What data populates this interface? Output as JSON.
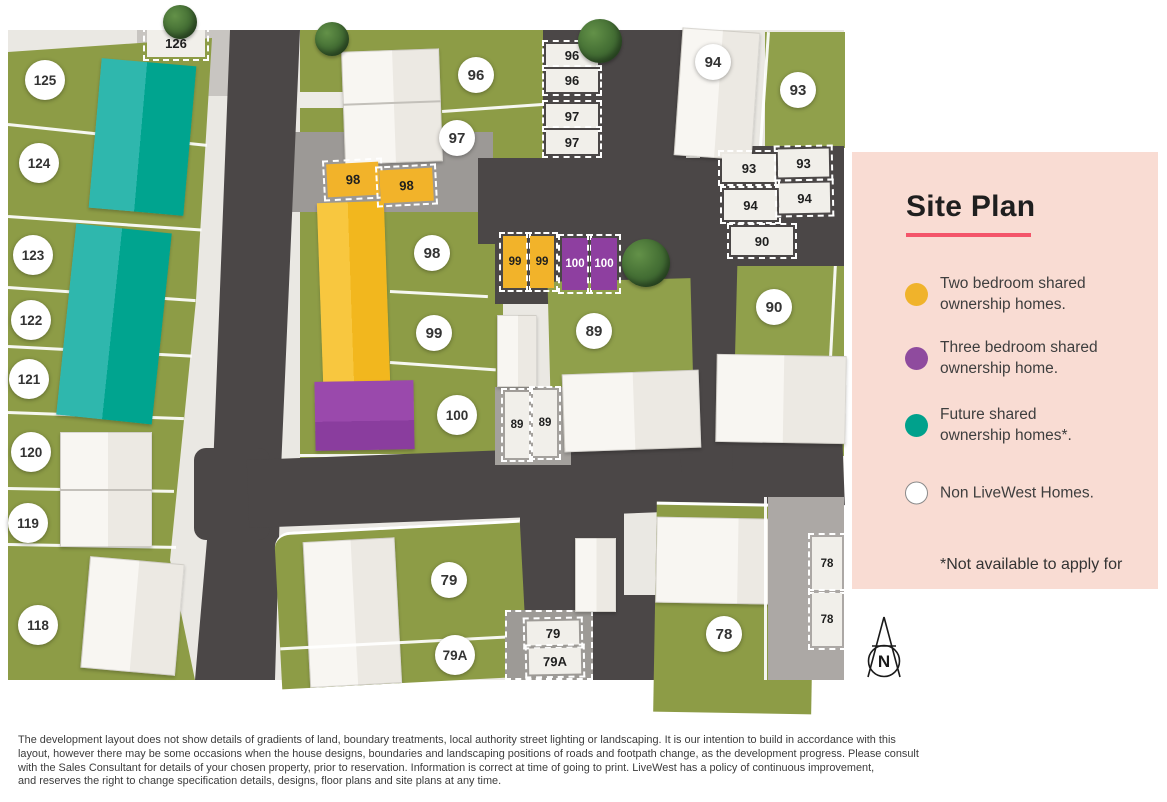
{
  "legend": {
    "title": "Site Plan",
    "items": [
      {
        "id": "two-bed-shared",
        "color": "#F0B32B",
        "line1": "Two bedroom shared",
        "line2": "ownership homes."
      },
      {
        "id": "three-bed-shared",
        "color": "#8F4B9E",
        "line1": "Three bedroom shared",
        "line2": "ownership home."
      },
      {
        "id": "future-shared",
        "color": "#00A18C",
        "line1": "Future shared",
        "line2": "ownership homes*."
      },
      {
        "id": "non-livewest",
        "color": "#FFFFFF",
        "line1": "Non LiveWest Homes.",
        "line2": ""
      }
    ],
    "footnote": "*Not available to apply for"
  },
  "compass": {
    "label": "N"
  },
  "map": {
    "plot_circles": [
      {
        "id": "125",
        "label": "125"
      },
      {
        "id": "124",
        "label": "124"
      },
      {
        "id": "123",
        "label": "123"
      },
      {
        "id": "122",
        "label": "122"
      },
      {
        "id": "121",
        "label": "121"
      },
      {
        "id": "120",
        "label": "120"
      },
      {
        "id": "119",
        "label": "119"
      },
      {
        "id": "118",
        "label": "118"
      },
      {
        "id": "96",
        "label": "96"
      },
      {
        "id": "97",
        "label": "97"
      },
      {
        "id": "98",
        "label": "98"
      },
      {
        "id": "99",
        "label": "99"
      },
      {
        "id": "100",
        "label": "100"
      },
      {
        "id": "89",
        "label": "89"
      },
      {
        "id": "90",
        "label": "90"
      },
      {
        "id": "94",
        "label": "94"
      },
      {
        "id": "93",
        "label": "93"
      },
      {
        "id": "79",
        "label": "79"
      },
      {
        "id": "79A",
        "label": "79A"
      },
      {
        "id": "78",
        "label": "78"
      }
    ],
    "parking_spaces": [
      {
        "id": "126",
        "label": "126",
        "type": "white"
      },
      {
        "id": "96a",
        "label": "96",
        "type": "white"
      },
      {
        "id": "96b",
        "label": "96",
        "type": "white"
      },
      {
        "id": "97a",
        "label": "97",
        "type": "white"
      },
      {
        "id": "97b",
        "label": "97",
        "type": "white"
      },
      {
        "id": "93a",
        "label": "93",
        "type": "white"
      },
      {
        "id": "93b",
        "label": "93",
        "type": "white"
      },
      {
        "id": "94a",
        "label": "94",
        "type": "white"
      },
      {
        "id": "94b",
        "label": "94",
        "type": "white"
      },
      {
        "id": "90p",
        "label": "90",
        "type": "white"
      },
      {
        "id": "89a",
        "label": "89",
        "type": "white"
      },
      {
        "id": "89b",
        "label": "89",
        "type": "white"
      },
      {
        "id": "79p",
        "label": "79",
        "type": "white"
      },
      {
        "id": "79Ap",
        "label": "79A",
        "type": "white"
      },
      {
        "id": "78a",
        "label": "78",
        "type": "white"
      },
      {
        "id": "78b",
        "label": "78",
        "type": "white"
      },
      {
        "id": "98a",
        "label": "98",
        "type": "yellow"
      },
      {
        "id": "98b",
        "label": "98",
        "type": "yellow"
      },
      {
        "id": "99a",
        "label": "99",
        "type": "yellow"
      },
      {
        "id": "99b",
        "label": "99",
        "type": "yellow"
      },
      {
        "id": "100a",
        "label": "100",
        "type": "purple"
      },
      {
        "id": "100b",
        "label": "100",
        "type": "purple"
      }
    ],
    "colors": {
      "two_bed_yellow": "#F2B32A",
      "three_bed_purple": "#8E3FA0",
      "future_teal": "#00A48F",
      "grass": "#8D9C46",
      "road": "#4B4747",
      "panel_pink": "#F9DCD3",
      "title_underline": "#F4556A"
    }
  },
  "disclaimer": {
    "line1": "The development layout does not show details of gradients of land, boundary treatments, local authority street lighting or landscaping. It is our intention to build in accordance with this",
    "line2": "layout, however there may be some occasions when the house designs, boundaries and landscaping positions of roads and footpath change, as the development progress. Please consult",
    "line3": "with the Sales Consultant for details of your chosen property, prior to reservation. Information is correct at time of going to print. LiveWest has a policy of continuous improvement,",
    "line4": "and reserves the right to change specification details, designs, floor plans and site plans at any time."
  }
}
